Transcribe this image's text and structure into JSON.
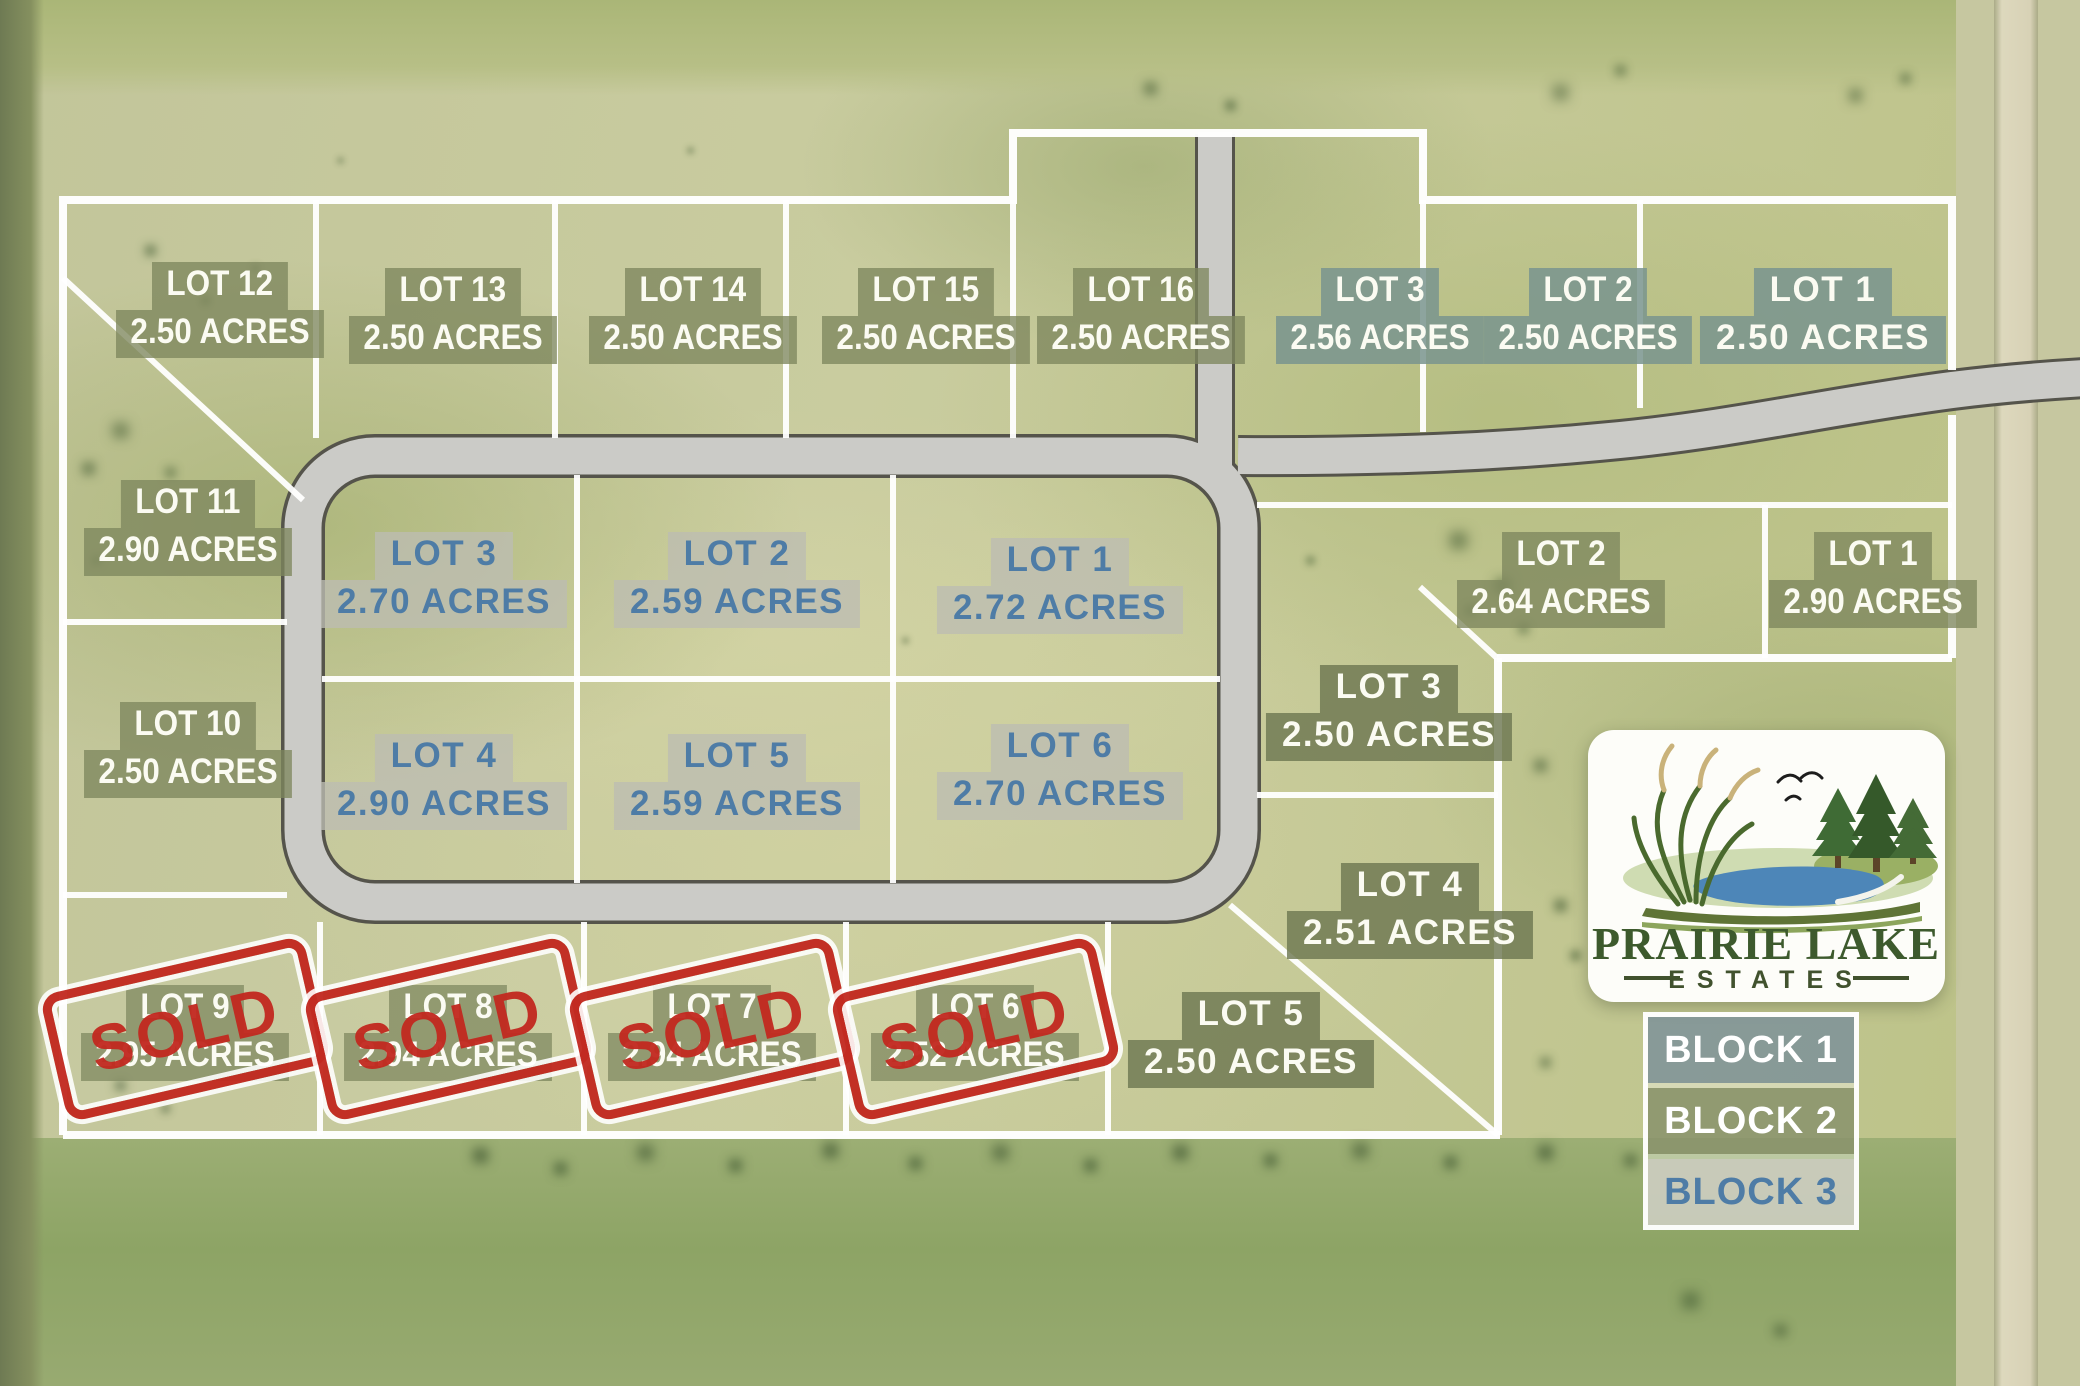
{
  "branding": {
    "line1": "PRAIRIE LAKE",
    "line2": "ESTATES"
  },
  "legend": {
    "blocks": [
      {
        "label": "BLOCK 1"
      },
      {
        "label": "BLOCK 2"
      },
      {
        "label": "BLOCK 3"
      }
    ]
  },
  "sold_stamp": {
    "label": "SOLD"
  },
  "lots": [
    {
      "name": "LOT 12",
      "acres": "2.50 ACRES",
      "block": "2",
      "style": "olive",
      "font": "condensed",
      "x": 220,
      "y": 262,
      "sold": false
    },
    {
      "name": "LOT 13",
      "acres": "2.50 ACRES",
      "block": "2",
      "style": "olive",
      "font": "condensed",
      "x": 453,
      "y": 268,
      "sold": false
    },
    {
      "name": "LOT 14",
      "acres": "2.50 ACRES",
      "block": "2",
      "style": "olive",
      "font": "condensed",
      "x": 693,
      "y": 268,
      "sold": false
    },
    {
      "name": "LOT 15",
      "acres": "2.50 ACRES",
      "block": "2",
      "style": "olive",
      "font": "condensed",
      "x": 926,
      "y": 268,
      "sold": false
    },
    {
      "name": "LOT 16",
      "acres": "2.50 ACRES",
      "block": "2",
      "style": "olive",
      "font": "condensed",
      "x": 1141,
      "y": 268,
      "sold": false
    },
    {
      "name": "LOT 3",
      "acres": "2.56 ACRES",
      "block": "1",
      "style": "bluegray",
      "font": "condensed",
      "x": 1380,
      "y": 268,
      "sold": false
    },
    {
      "name": "LOT 2",
      "acres": "2.50 ACRES",
      "block": "1",
      "style": "bluegray",
      "font": "condensed",
      "x": 1588,
      "y": 268,
      "sold": false
    },
    {
      "name": "LOT 1",
      "acres": "2.50 ACRES",
      "block": "1",
      "style": "bluegray",
      "font": "wide",
      "x": 1823,
      "y": 268,
      "sold": false
    },
    {
      "name": "LOT 11",
      "acres": "2.90 ACRES",
      "block": "2",
      "style": "olive",
      "font": "condensed",
      "x": 188,
      "y": 480,
      "sold": false
    },
    {
      "name": "LOT 10",
      "acres": "2.50 ACRES",
      "block": "2",
      "style": "olive",
      "font": "condensed",
      "x": 188,
      "y": 702,
      "sold": false
    },
    {
      "name": "LOT 3",
      "acres": "2.70 ACRES",
      "block": "3",
      "style": "gray-blue",
      "font": "wide",
      "x": 444,
      "y": 532,
      "sold": false
    },
    {
      "name": "LOT 2",
      "acres": "2.59 ACRES",
      "block": "3",
      "style": "gray-blue",
      "font": "wide",
      "x": 737,
      "y": 532,
      "sold": false
    },
    {
      "name": "LOT 1",
      "acres": "2.72 ACRES",
      "block": "3",
      "style": "gray-blue",
      "font": "wide",
      "x": 1060,
      "y": 538,
      "sold": false
    },
    {
      "name": "LOT 4",
      "acres": "2.90 ACRES",
      "block": "3",
      "style": "gray-blue",
      "font": "wide",
      "x": 444,
      "y": 734,
      "sold": false
    },
    {
      "name": "LOT 5",
      "acres": "2.59 ACRES",
      "block": "3",
      "style": "gray-blue",
      "font": "wide",
      "x": 737,
      "y": 734,
      "sold": false
    },
    {
      "name": "LOT 6",
      "acres": "2.70 ACRES",
      "block": "3",
      "style": "gray-blue",
      "font": "wide",
      "x": 1060,
      "y": 724,
      "sold": false
    },
    {
      "name": "LOT 2",
      "acres": "2.64 ACRES",
      "block": "2",
      "style": "olive",
      "font": "condensed",
      "x": 1561,
      "y": 532,
      "sold": false
    },
    {
      "name": "LOT 1",
      "acres": "2.90 ACRES",
      "block": "2",
      "style": "olive",
      "font": "condensed",
      "x": 1873,
      "y": 532,
      "sold": false
    },
    {
      "name": "LOT 3",
      "acres": "2.50 ACRES",
      "block": "2",
      "style": "olive-dark",
      "font": "wide",
      "x": 1389,
      "y": 665,
      "sold": false
    },
    {
      "name": "LOT 4",
      "acres": "2.51 ACRES",
      "block": "2",
      "style": "olive-dark",
      "font": "wide",
      "x": 1410,
      "y": 863,
      "sold": false
    },
    {
      "name": "LOT 5",
      "acres": "2.50 ACRES",
      "block": "2",
      "style": "olive-dark",
      "font": "wide",
      "x": 1251,
      "y": 992,
      "sold": false
    },
    {
      "name": "LOT 9",
      "acres": "2.95 ACRES",
      "block": "2",
      "style": "olive",
      "font": "condensed",
      "x": 185,
      "y": 985,
      "sold": true
    },
    {
      "name": "LOT 8",
      "acres": "2.94 ACRES",
      "block": "2",
      "style": "olive",
      "font": "condensed",
      "x": 448,
      "y": 985,
      "sold": true
    },
    {
      "name": "LOT 7",
      "acres": "2.94 ACRES",
      "block": "2",
      "style": "olive",
      "font": "condensed",
      "x": 712,
      "y": 985,
      "sold": true
    },
    {
      "name": "LOT 6",
      "acres": "2.52 ACRES",
      "block": "2",
      "style": "olive",
      "font": "condensed",
      "x": 975,
      "y": 985,
      "sold": true
    }
  ]
}
